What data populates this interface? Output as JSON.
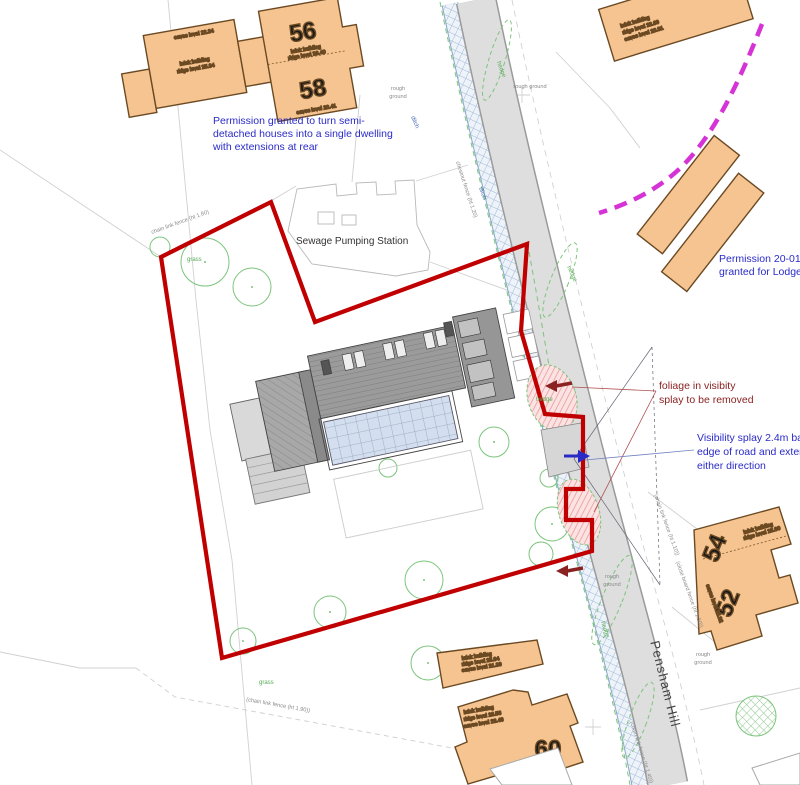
{
  "annotations": {
    "permission_semi_1": "Permission granted to turn semi-",
    "permission_semi_2": "detached houses into a single dwelling",
    "permission_semi_3": "with extensions at rear",
    "permission_lodge_1": "Permission 20-01732-O",
    "permission_lodge_2": "granted for Lodge Cara",
    "foliage_1": "foliage in visibity",
    "foliage_2": "splay to be removed",
    "visibility_1": "Visibility splay 2.4m ba",
    "visibility_2": "edge of road and exten",
    "visibility_3": "either direction",
    "pumping_station": "Sewage Pumping Station",
    "road_name": "Pensham Hill"
  },
  "house_numbers": {
    "n56": "56",
    "n58": "58",
    "n54": "54",
    "n52": "52",
    "n60": "60"
  },
  "building_notes": {
    "semi_1": "brick building",
    "semi_2": "ridge level 25.84",
    "semi_eaves": "eaves level 22.34",
    "b56_1": "brick building",
    "b56_2": "ridge level 26.40",
    "b58_eaves": "eaves level 20.41",
    "tr_1": "brick building",
    "tr_2": "ridge level 23.69",
    "tr_3": "eaves level 20.31",
    "b54_1": "brick building",
    "b54_2": "ridge level 28.80",
    "b54_eaves": "eaves level 25.92",
    "out_1": "brick building",
    "out_2": "ridge level 25.94",
    "out_3": "eaves level 21.39",
    "b60_1": "brick building",
    "b60_2": "ridge level 26.56",
    "b60_3": "eaves level 23.46"
  },
  "ground_labels": {
    "rough_ground": "rough ground",
    "rough": "rough",
    "ground": "ground",
    "grass": "grass",
    "hedge": "hedge",
    "ditch": "ditch"
  },
  "fence_labels": {
    "chain_180": "chain link fence (ht 1.80)",
    "chain_190": "(chain link fence (ht 1.90))",
    "chestnut": "chestnut fence (ht 1.20)",
    "chain_110": "(chain link fence (ht 1.10))",
    "board_150": "(close board fence (ht 1.50))",
    "chain_140": "(chain link fence (ht 1.40))"
  },
  "colors": {
    "boundary_red": "#c00000",
    "annotation_blue": "#2a2ac8",
    "annotation_dark_red": "#8b2222",
    "proposal_magenta": "#d633d6",
    "building_fill": "#f6c490",
    "building_stroke": "#6b4a23",
    "vegetation_green": "#7cc47c",
    "road_fill": "#dedede",
    "ditch_blue": "#a9c2dd"
  }
}
